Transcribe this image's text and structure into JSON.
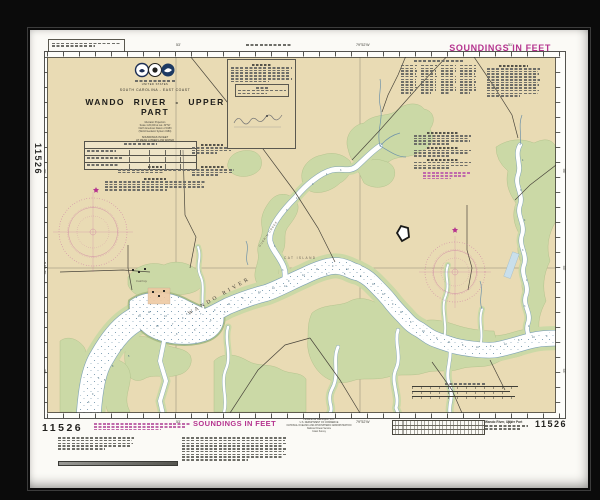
{
  "chart_number": "11526",
  "soundings_note": "SOUNDINGS IN FEET",
  "title_block": {
    "country": "UNITED STATES",
    "region": "SOUTH CAROLINA - EAST COAST",
    "title": "WANDO RIVER - UPPER PART",
    "projection_lines": [
      "Mercator Projection",
      "Scale 1:20,000 at Lat. 32°52'",
      "North American Datum of 1983",
      "(World Geodetic System 1984)"
    ],
    "soundings_lines": [
      "SOUNDINGS IN FEET",
      "AT MEAN LOWER LOW WATER"
    ]
  },
  "map": {
    "river_label": "WANDO RIVER",
    "island_label": "CAT ISLAND",
    "creek_label": "GUERIN CREEK",
    "place_label": "Cainhoy",
    "colors": {
      "land": "#e9dbb4",
      "marsh": "#cbd9a6",
      "water": "#ffffff",
      "water_edge": "#7fa3b5",
      "rose_magenta": "#c25b9e",
      "accent_magenta": "#b5348f",
      "road": "#4a463c"
    },
    "border_labels": {
      "top": [
        {
          "x": 146,
          "t": "53'"
        },
        {
          "x": 326,
          "t": "79°52'W"
        },
        {
          "x": 478,
          "t": "51'"
        }
      ],
      "bottom": [
        {
          "x": 146,
          "t": "53'"
        },
        {
          "x": 326,
          "t": "79°52'W"
        },
        {
          "x": 478,
          "t": "51'"
        }
      ],
      "left": [
        {
          "y": 120,
          "t": "56'"
        },
        {
          "y": 217,
          "t": "32°55'N"
        },
        {
          "y": 320,
          "t": "54'"
        }
      ],
      "right": [
        {
          "y": 120,
          "t": "56'"
        },
        {
          "y": 217,
          "t": "55'"
        },
        {
          "y": 320,
          "t": "54'"
        }
      ]
    },
    "soundings": [
      {
        "x": 48,
        "y": 344,
        "v": 9
      },
      {
        "x": 44,
        "y": 352,
        "v": 6
      },
      {
        "x": 54,
        "y": 328,
        "v": 4
      },
      {
        "x": 60,
        "y": 330,
        "v": 5
      },
      {
        "x": 68,
        "y": 316,
        "v": 8
      },
      {
        "x": 76,
        "y": 300,
        "v": 7
      },
      {
        "x": 84,
        "y": 306,
        "v": 5
      },
      {
        "x": 96,
        "y": 280,
        "v": 6
      },
      {
        "x": 104,
        "y": 262,
        "v": 11
      },
      {
        "x": 112,
        "y": 276,
        "v": 12
      },
      {
        "x": 120,
        "y": 266,
        "v": 13
      },
      {
        "x": 132,
        "y": 284,
        "v": 8
      },
      {
        "x": 138,
        "y": 268,
        "v": 9
      },
      {
        "x": 150,
        "y": 280,
        "v": 5
      },
      {
        "x": 156,
        "y": 264,
        "v": 7
      },
      {
        "x": 166,
        "y": 270,
        "v": 6
      },
      {
        "x": 170,
        "y": 260,
        "v": 9
      },
      {
        "x": 184,
        "y": 254,
        "v": 11
      },
      {
        "x": 198,
        "y": 248,
        "v": 8
      },
      {
        "x": 206,
        "y": 252,
        "v": 4
      },
      {
        "x": 214,
        "y": 242,
        "v": 12
      },
      {
        "x": 228,
        "y": 238,
        "v": 10
      },
      {
        "x": 240,
        "y": 236,
        "v": 14
      },
      {
        "x": 244,
        "y": 231,
        "v": 9
      },
      {
        "x": 258,
        "y": 225,
        "v": 13
      },
      {
        "x": 272,
        "y": 219,
        "v": 11
      },
      {
        "x": 282,
        "y": 224,
        "v": 6
      },
      {
        "x": 288,
        "y": 216,
        "v": 9
      },
      {
        "x": 300,
        "y": 224,
        "v": 5
      },
      {
        "x": 302,
        "y": 219,
        "v": 12
      },
      {
        "x": 316,
        "y": 226,
        "v": 8
      },
      {
        "x": 328,
        "y": 234,
        "v": 10
      },
      {
        "x": 338,
        "y": 244,
        "v": 12
      },
      {
        "x": 348,
        "y": 254,
        "v": 9
      },
      {
        "x": 356,
        "y": 262,
        "v": 11
      },
      {
        "x": 366,
        "y": 272,
        "v": 8
      },
      {
        "x": 378,
        "y": 281,
        "v": 10
      },
      {
        "x": 392,
        "y": 288,
        "v": 9
      },
      {
        "x": 404,
        "y": 292,
        "v": 11
      },
      {
        "x": 418,
        "y": 295,
        "v": 8
      },
      {
        "x": 432,
        "y": 297,
        "v": 10
      },
      {
        "x": 446,
        "y": 296,
        "v": 9
      },
      {
        "x": 460,
        "y": 294,
        "v": 12
      },
      {
        "x": 474,
        "y": 290,
        "v": 8
      },
      {
        "x": 488,
        "y": 287,
        "v": 10
      },
      {
        "x": 502,
        "y": 286,
        "v": 9
      },
      {
        "x": 238,
        "y": 220,
        "v": 3
      },
      {
        "x": 230,
        "y": 196,
        "v": 4
      },
      {
        "x": 242,
        "y": 160,
        "v": 3
      },
      {
        "x": 252,
        "y": 148,
        "v": 4
      },
      {
        "x": 268,
        "y": 134,
        "v": 3
      },
      {
        "x": 282,
        "y": 124,
        "v": 4
      },
      {
        "x": 296,
        "y": 120,
        "v": 3
      },
      {
        "x": 478,
        "y": 110,
        "v": 4
      },
      {
        "x": 476,
        "y": 140,
        "v": 3
      },
      {
        "x": 480,
        "y": 170,
        "v": 4
      },
      {
        "x": 478,
        "y": 200,
        "v": 3
      },
      {
        "x": 482,
        "y": 230,
        "v": 4
      },
      {
        "x": 480,
        "y": 256,
        "v": 3
      },
      {
        "x": 484,
        "y": 276,
        "v": 4
      },
      {
        "x": 94,
        "y": 266,
        "v": 15
      },
      {
        "x": 128,
        "y": 274,
        "v": 7
      },
      {
        "x": 142,
        "y": 264,
        "v": 6
      },
      {
        "x": 180,
        "y": 262,
        "v": 5
      }
    ]
  },
  "bottom_margin": {
    "publisher_lines": [
      "Published at Washington, D.C.",
      "U.S. DEPARTMENT OF COMMERCE",
      "NATIONAL OCEANIC AND ATMOSPHERIC ADMINISTRATION",
      "National Ocean Service",
      "Coast Survey"
    ],
    "product_title": "Wando River, Upper Part"
  }
}
